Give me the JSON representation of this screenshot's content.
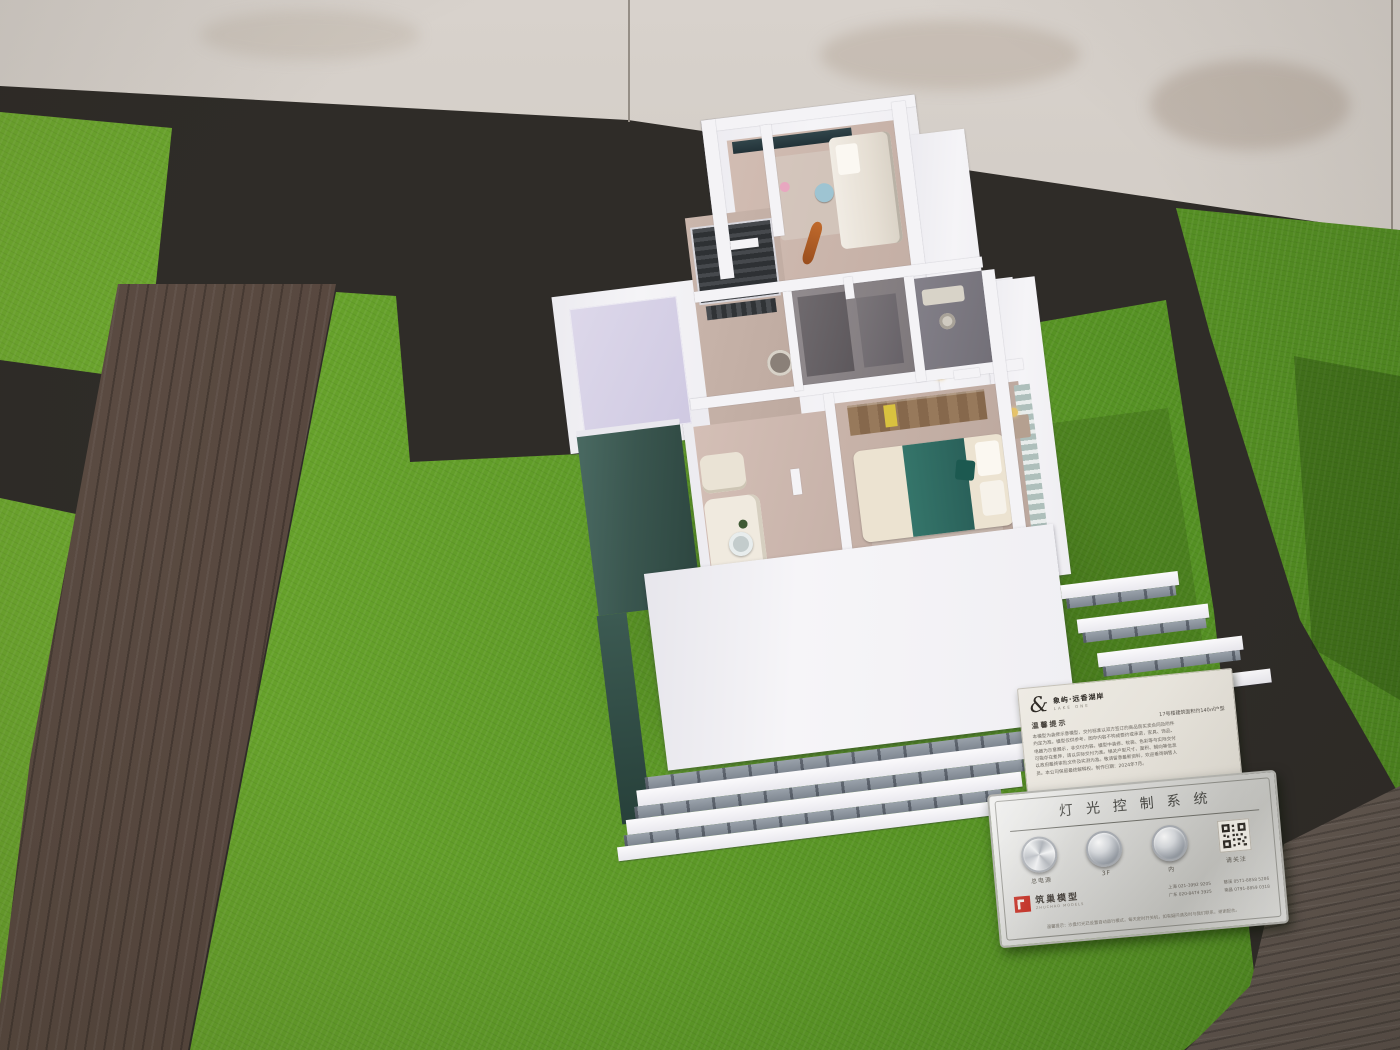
{
  "colors": {
    "grass_green": "#5f9b28",
    "walkway_dark": "#2f2c28",
    "plank_brown": "#55463d",
    "deck_wood": "#6e625a",
    "concrete_wall": "#ccc6c0",
    "model_white": "#f3f2f5",
    "roof_lavender": "#d7d2e6",
    "glass_teal": "#3c5a52",
    "bed_teal": "#2f6b61",
    "logo_red": "#c4281c",
    "panel_silver": "#d6d6d3"
  },
  "info_card": {
    "brand_symbol": "&",
    "brand_name": "象屿·远香湖岸",
    "brand_sub": "LAKE ONE",
    "title": "温馨提示",
    "subtitle": "17号楼建筑面积约140㎡户型",
    "body_lines": [
      "本模型为装修示意模型，交付标准以双方签订的商品房买卖合同及附件",
      "约定为准。模型仅供参考，图中内容不构成要约或承诺，家具、饰品、",
      "电器为示意展示，非交付内容。模型中装修、软装、色彩等与实际交付",
      "可能存在差异，请以实际交付为准。相关户型尺寸、面积、朝向等信息",
      "以政府最终审批文件及实测为准。敬请留意最新资料，欢迎垂询销售人",
      "员。本公司保留最终解释权。制作日期：2024年7月。"
    ]
  },
  "control_panel": {
    "title": "灯光控制系统",
    "buttons": [
      {
        "label": "总电源"
      },
      {
        "label": "3F"
      },
      {
        "label": "内"
      },
      {
        "label": "请关注"
      }
    ],
    "logo_text": "筑巢模型",
    "logo_sub": "ZHUCHAO MODELS",
    "phones": [
      "上海 021-3992 9205",
      "广东 020-8474 3925",
      "慈溪 0571-8858 5286",
      "南昌 0791-8859 0318"
    ],
    "footnote": "温馨提示：沙盘灯光已设置自动运行模式，每天定时开关机，如有疑问请及时与我们联系，谢谢配合。"
  }
}
